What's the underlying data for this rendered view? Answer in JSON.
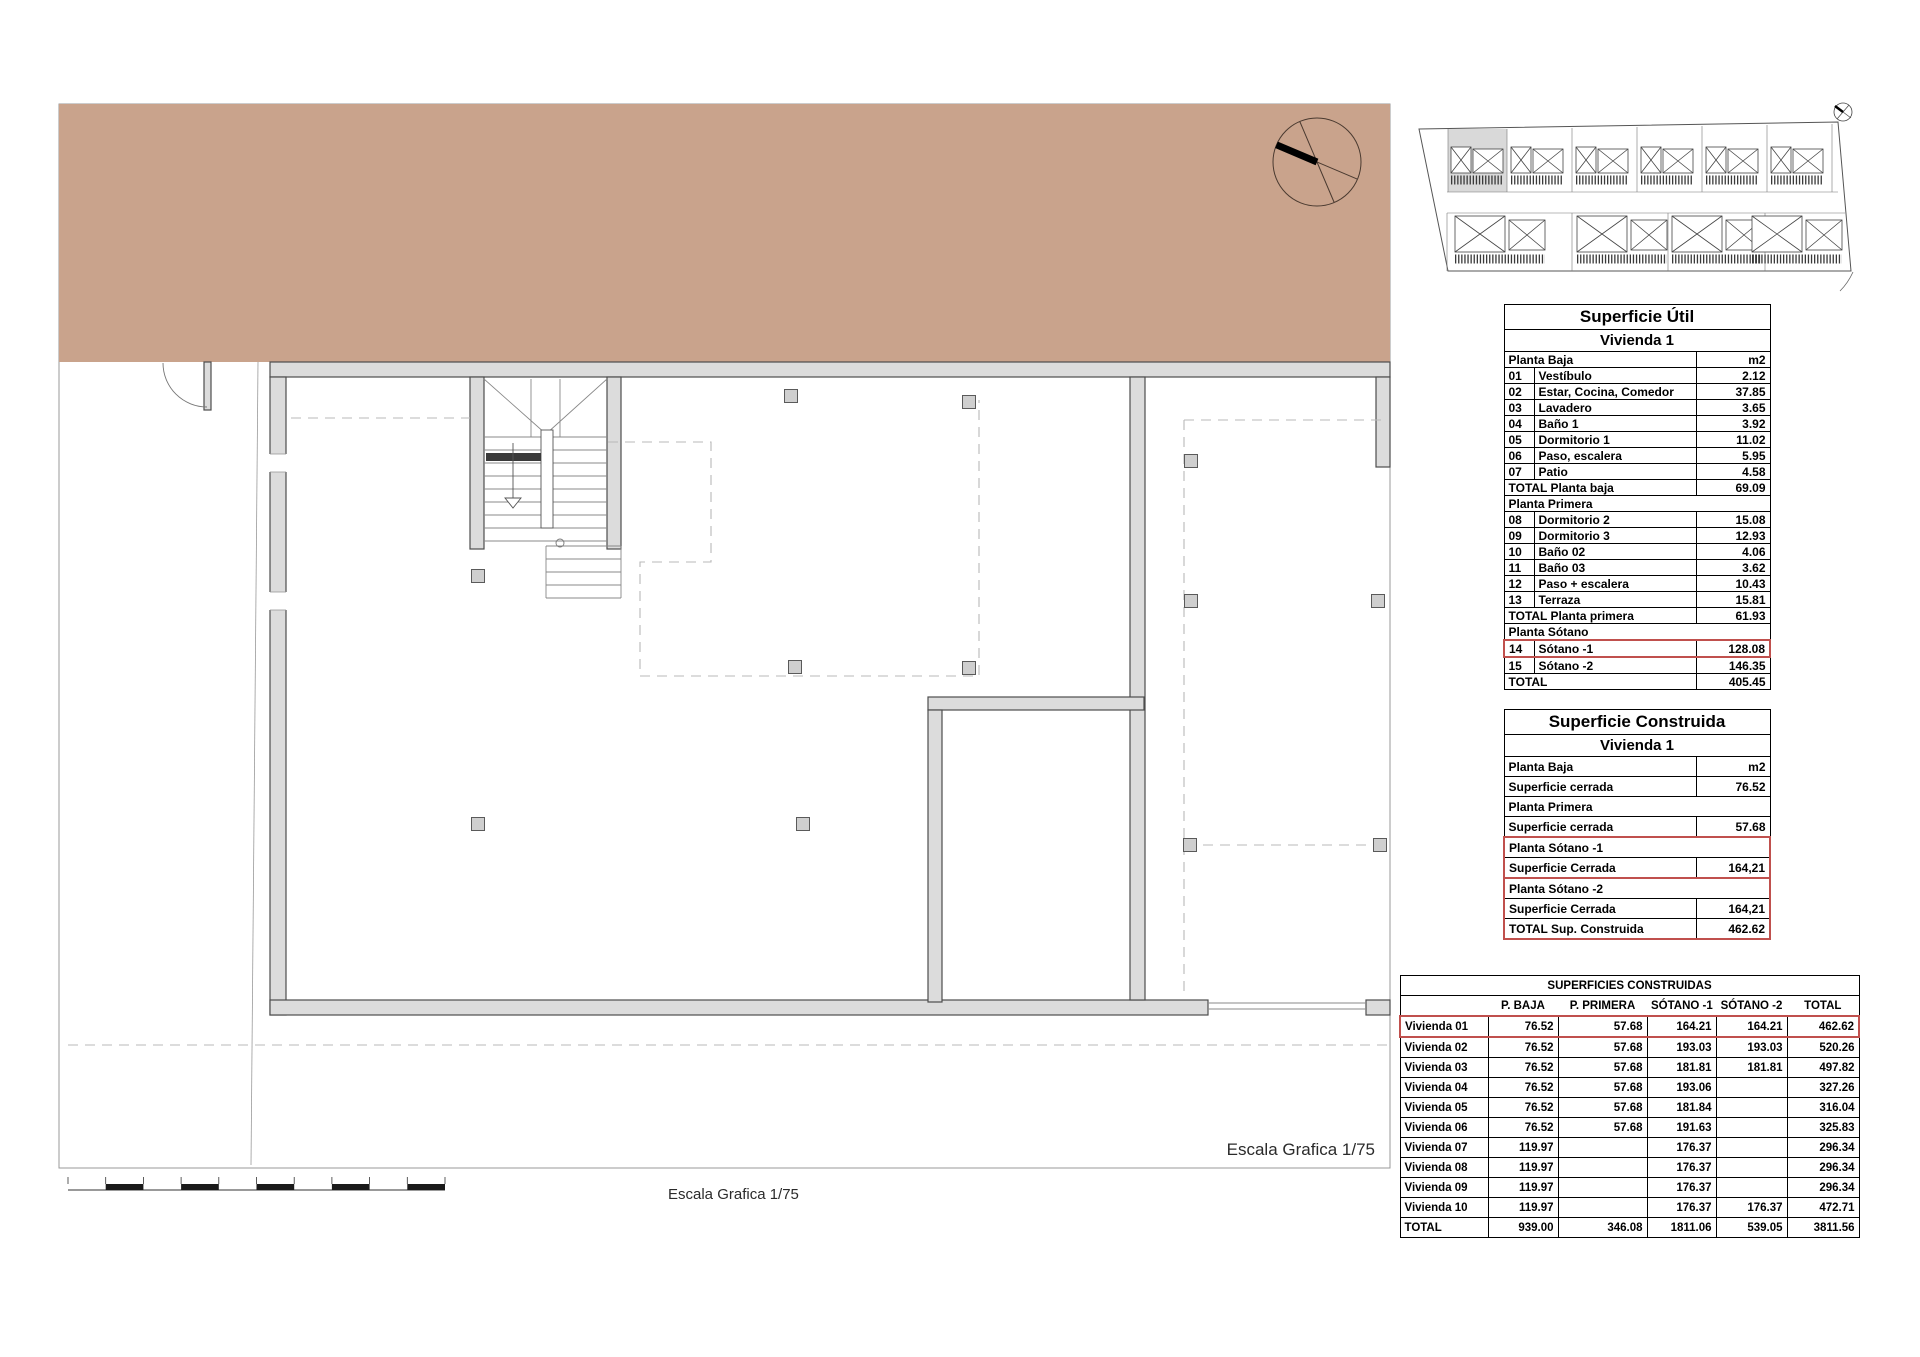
{
  "sheet": {
    "scale_label": "Escala Grafica 1/75",
    "colors": {
      "terrain": "#c9a38c",
      "wall_fill": "#dcdcdc",
      "wall_stroke": "#4d4d4d",
      "column_fill": "#cfcfcf",
      "dashed_line": "#b8b8b8",
      "highlight_red": "#c0504d",
      "site_highlight_gray": "#d9d9d9"
    }
  },
  "tables": {
    "util": {
      "title": "Superficie Útil",
      "subtitle": "Vivienda 1",
      "rows": [
        {
          "t": "unit",
          "a": "Planta Baja",
          "v": "m2"
        },
        {
          "t": "item",
          "n": "01",
          "a": "Vestíbulo",
          "v": "2.12"
        },
        {
          "t": "item",
          "n": "02",
          "a": "Estar, Cocina, Comedor",
          "v": "37.85",
          "tall": true
        },
        {
          "t": "item",
          "n": "03",
          "a": "Lavadero",
          "v": "3.65"
        },
        {
          "t": "item",
          "n": "04",
          "a": "Baño 1",
          "v": "3.92"
        },
        {
          "t": "item",
          "n": "05",
          "a": "Dormitorio 1",
          "v": "11.02"
        },
        {
          "t": "item",
          "n": "06",
          "a": "Paso, escalera",
          "v": "5.95"
        },
        {
          "t": "item",
          "n": "07",
          "a": "Patio",
          "v": "4.58"
        },
        {
          "t": "total",
          "a": "TOTAL Planta baja",
          "v": "69.09"
        },
        {
          "t": "section",
          "a": "Planta Primera"
        },
        {
          "t": "item",
          "n": "08",
          "a": "Dormitorio 2",
          "v": "15.08"
        },
        {
          "t": "item",
          "n": "09",
          "a": "Dormitorio 3",
          "v": "12.93"
        },
        {
          "t": "item",
          "n": "10",
          "a": "Baño 02",
          "v": "4.06"
        },
        {
          "t": "item",
          "n": "11",
          "a": "Baño 03",
          "v": "3.62"
        },
        {
          "t": "item",
          "n": "12",
          "a": "Paso + escalera",
          "v": "10.43"
        },
        {
          "t": "item",
          "n": "13",
          "a": "Terraza",
          "v": "15.81"
        },
        {
          "t": "total",
          "a": "TOTAL Planta primera",
          "v": "61.93"
        },
        {
          "t": "section",
          "a": "Planta Sótano"
        },
        {
          "t": "item",
          "n": "14",
          "a": "Sótano -1",
          "v": "128.08",
          "hl": true
        },
        {
          "t": "item",
          "n": "15",
          "a": "Sótano -2",
          "v": "146.35"
        },
        {
          "t": "total",
          "a": "TOTAL",
          "v": "405.45"
        }
      ]
    },
    "construida": {
      "title": "Superficie Construida",
      "subtitle": "Vivienda 1",
      "rows": [
        {
          "t": "unit",
          "a": "Planta Baja",
          "v": "m2"
        },
        {
          "t": "row",
          "a": "Superficie cerrada",
          "v": "76.52"
        },
        {
          "t": "section",
          "a": "Planta Primera"
        },
        {
          "t": "row",
          "a": "Superficie cerrada",
          "v": "57.68"
        },
        {
          "t": "section",
          "a": "Planta Sótano -1",
          "hl": "rt"
        },
        {
          "t": "row",
          "a": "Superficie Cerrada",
          "v": "164,21",
          "hl": "rs"
        },
        {
          "t": "section",
          "a": "Planta Sótano -2",
          "hl": "rt"
        },
        {
          "t": "row",
          "a": "Superficie Cerrada",
          "v": "164,21",
          "hl": "rs"
        },
        {
          "t": "total",
          "a": "TOTAL Sup. Construida",
          "v": "462.62",
          "hl": "rb"
        }
      ]
    },
    "resumen": {
      "title": "SUPERFICIES CONSTRUIDAS",
      "columns": [
        "",
        "P. BAJA",
        "P. PRIMERA",
        "SÓTANO -1",
        "SÓTANO -2",
        "TOTAL"
      ],
      "rows": [
        {
          "label": "Vivienda 01",
          "values": [
            "76.52",
            "57.68",
            "164.21",
            "164.21",
            "462.62"
          ],
          "highlight": true
        },
        {
          "label": "Vivienda 02",
          "values": [
            "76.52",
            "57.68",
            "193.03",
            "193.03",
            "520.26"
          ]
        },
        {
          "label": "Vivienda 03",
          "values": [
            "76.52",
            "57.68",
            "181.81",
            "181.81",
            "497.82"
          ]
        },
        {
          "label": "Vivienda 04",
          "values": [
            "76.52",
            "57.68",
            "193.06",
            "",
            "327.26"
          ]
        },
        {
          "label": "Vivienda 05",
          "values": [
            "76.52",
            "57.68",
            "181.84",
            "",
            "316.04"
          ]
        },
        {
          "label": "Vivienda 06",
          "values": [
            "76.52",
            "57.68",
            "191.63",
            "",
            "325.83"
          ]
        },
        {
          "label": "Vivienda 07",
          "values": [
            "119.97",
            "",
            "176.37",
            "",
            "296.34"
          ]
        },
        {
          "label": "Vivienda 08",
          "values": [
            "119.97",
            "",
            "176.37",
            "",
            "296.34"
          ]
        },
        {
          "label": "Vivienda 09",
          "values": [
            "119.97",
            "",
            "176.37",
            "",
            "296.34"
          ]
        },
        {
          "label": "Vivienda 10",
          "values": [
            "119.97",
            "",
            "176.37",
            "176.37",
            "472.71"
          ]
        },
        {
          "label": "TOTAL",
          "values": [
            "939.00",
            "346.08",
            "1811.06",
            "539.05",
            "3811.56"
          ],
          "total": true
        }
      ]
    }
  }
}
